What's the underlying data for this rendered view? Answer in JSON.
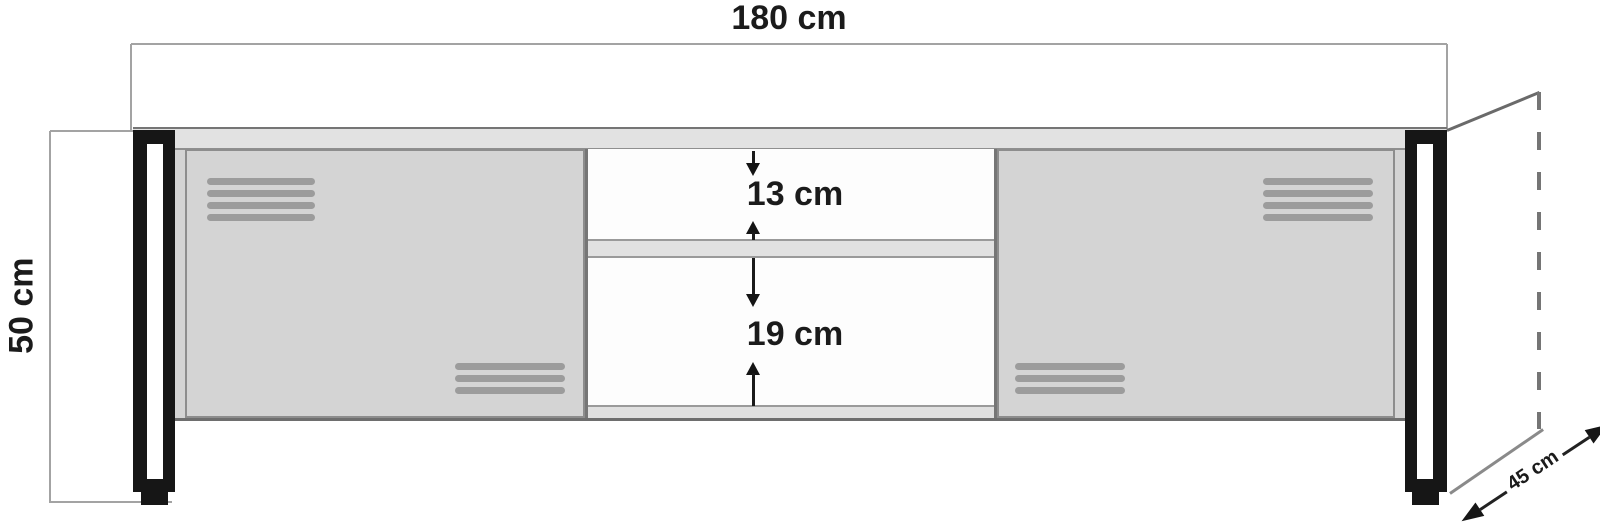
{
  "diagram": {
    "type": "furniture-dimension-drawing",
    "subject": "TV stand front elevation with depth perspective",
    "labels": {
      "width": "180 cm",
      "height": "50 cm",
      "depth": "45 cm",
      "upper_opening": "13 cm",
      "lower_opening": "19 cm"
    },
    "dimensions_cm": {
      "width": 180,
      "height": 50,
      "depth": 45,
      "upper_opening": 13,
      "lower_opening": 19
    },
    "vents": {
      "left_top_slats": 4,
      "left_bottom_slats": 3,
      "right_top_slats": 4,
      "right_bottom_slats": 3
    },
    "colors": {
      "background": "#ffffff",
      "door_fill": "#d4d4d4",
      "top_panel_fill": "#e2e2e2",
      "shelf_fill": "#e1e1e1",
      "vent_slat": "#9c9c9c",
      "leg": "#161616",
      "dimension_line": "#a3a3a3",
      "text": "#1b1b1b"
    }
  }
}
